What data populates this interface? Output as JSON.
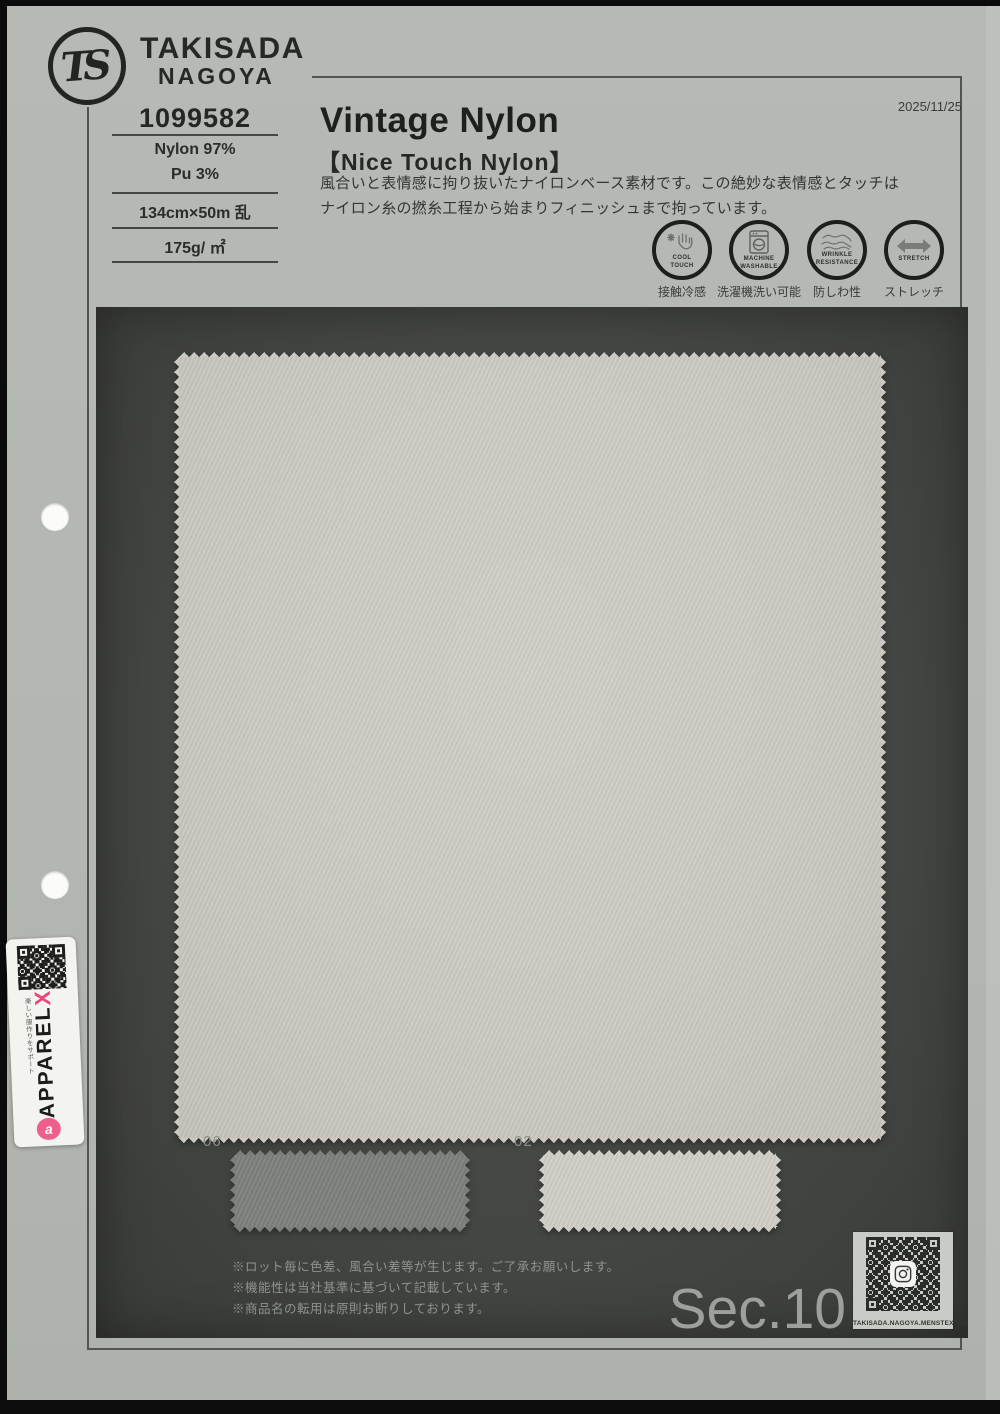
{
  "header": {
    "logo_monogram": "TS",
    "brand_line1": "TAKISADA",
    "brand_line2": "NAGOYA",
    "date": "2025/11/25"
  },
  "product": {
    "number": "1099582",
    "composition": [
      "Nylon 97%",
      "Pu 3%"
    ],
    "size": "134cm×50m 乱",
    "weight": "175g/ ㎡",
    "title": "Vintage Nylon",
    "subtitle": "【Nice Touch Nylon】",
    "description": [
      "風合いと表情感に拘り抜いたナイロンベース素材です。この絶妙な表情感とタッチは",
      "ナイロン糸の撚糸工程から始まりフィニッシュまで拘っています。"
    ]
  },
  "features": [
    {
      "icon": "cool-touch-icon",
      "en1": "COOL",
      "en2": "TOUCH",
      "jp": "接触冷感"
    },
    {
      "icon": "machine-washable-icon",
      "en1": "MACHINE",
      "en2": "WASHABLE",
      "jp": "洗濯機洗い可能"
    },
    {
      "icon": "wrinkle-resistance-icon",
      "en1": "WRINKLE",
      "en2": "RESISTANCE",
      "jp": "防しわ性"
    },
    {
      "icon": "stretch-icon",
      "en1": "STRETCH",
      "en2": "",
      "jp": "ストレッチ"
    }
  ],
  "board": {
    "color_codes": [
      "06",
      "02"
    ],
    "notes": [
      "※ロット毎に色差、風合い差等が生じます。ご了承お願いします。",
      "※機能性は当社基準に基づいて記載しています。",
      "※商品名の転用は原則お断りしております。"
    ],
    "section_label": "Sec.10",
    "qr_caption": "TAKISADA.NAGOYA.MENSTEXTILE"
  },
  "sticker": {
    "brand": "APPAREL",
    "x_mark": "X",
    "tagline": "楽しい服作りをサポート",
    "logo_letter": "a"
  },
  "colors": {
    "paper": "#b3b6b1",
    "panel": "#454744",
    "fabric_main": "#cbc9c1",
    "fabric_06": "#7c7e7b",
    "fabric_02": "#cfcdc5",
    "accent_pink": "#e8457a",
    "ink": "#222422"
  }
}
